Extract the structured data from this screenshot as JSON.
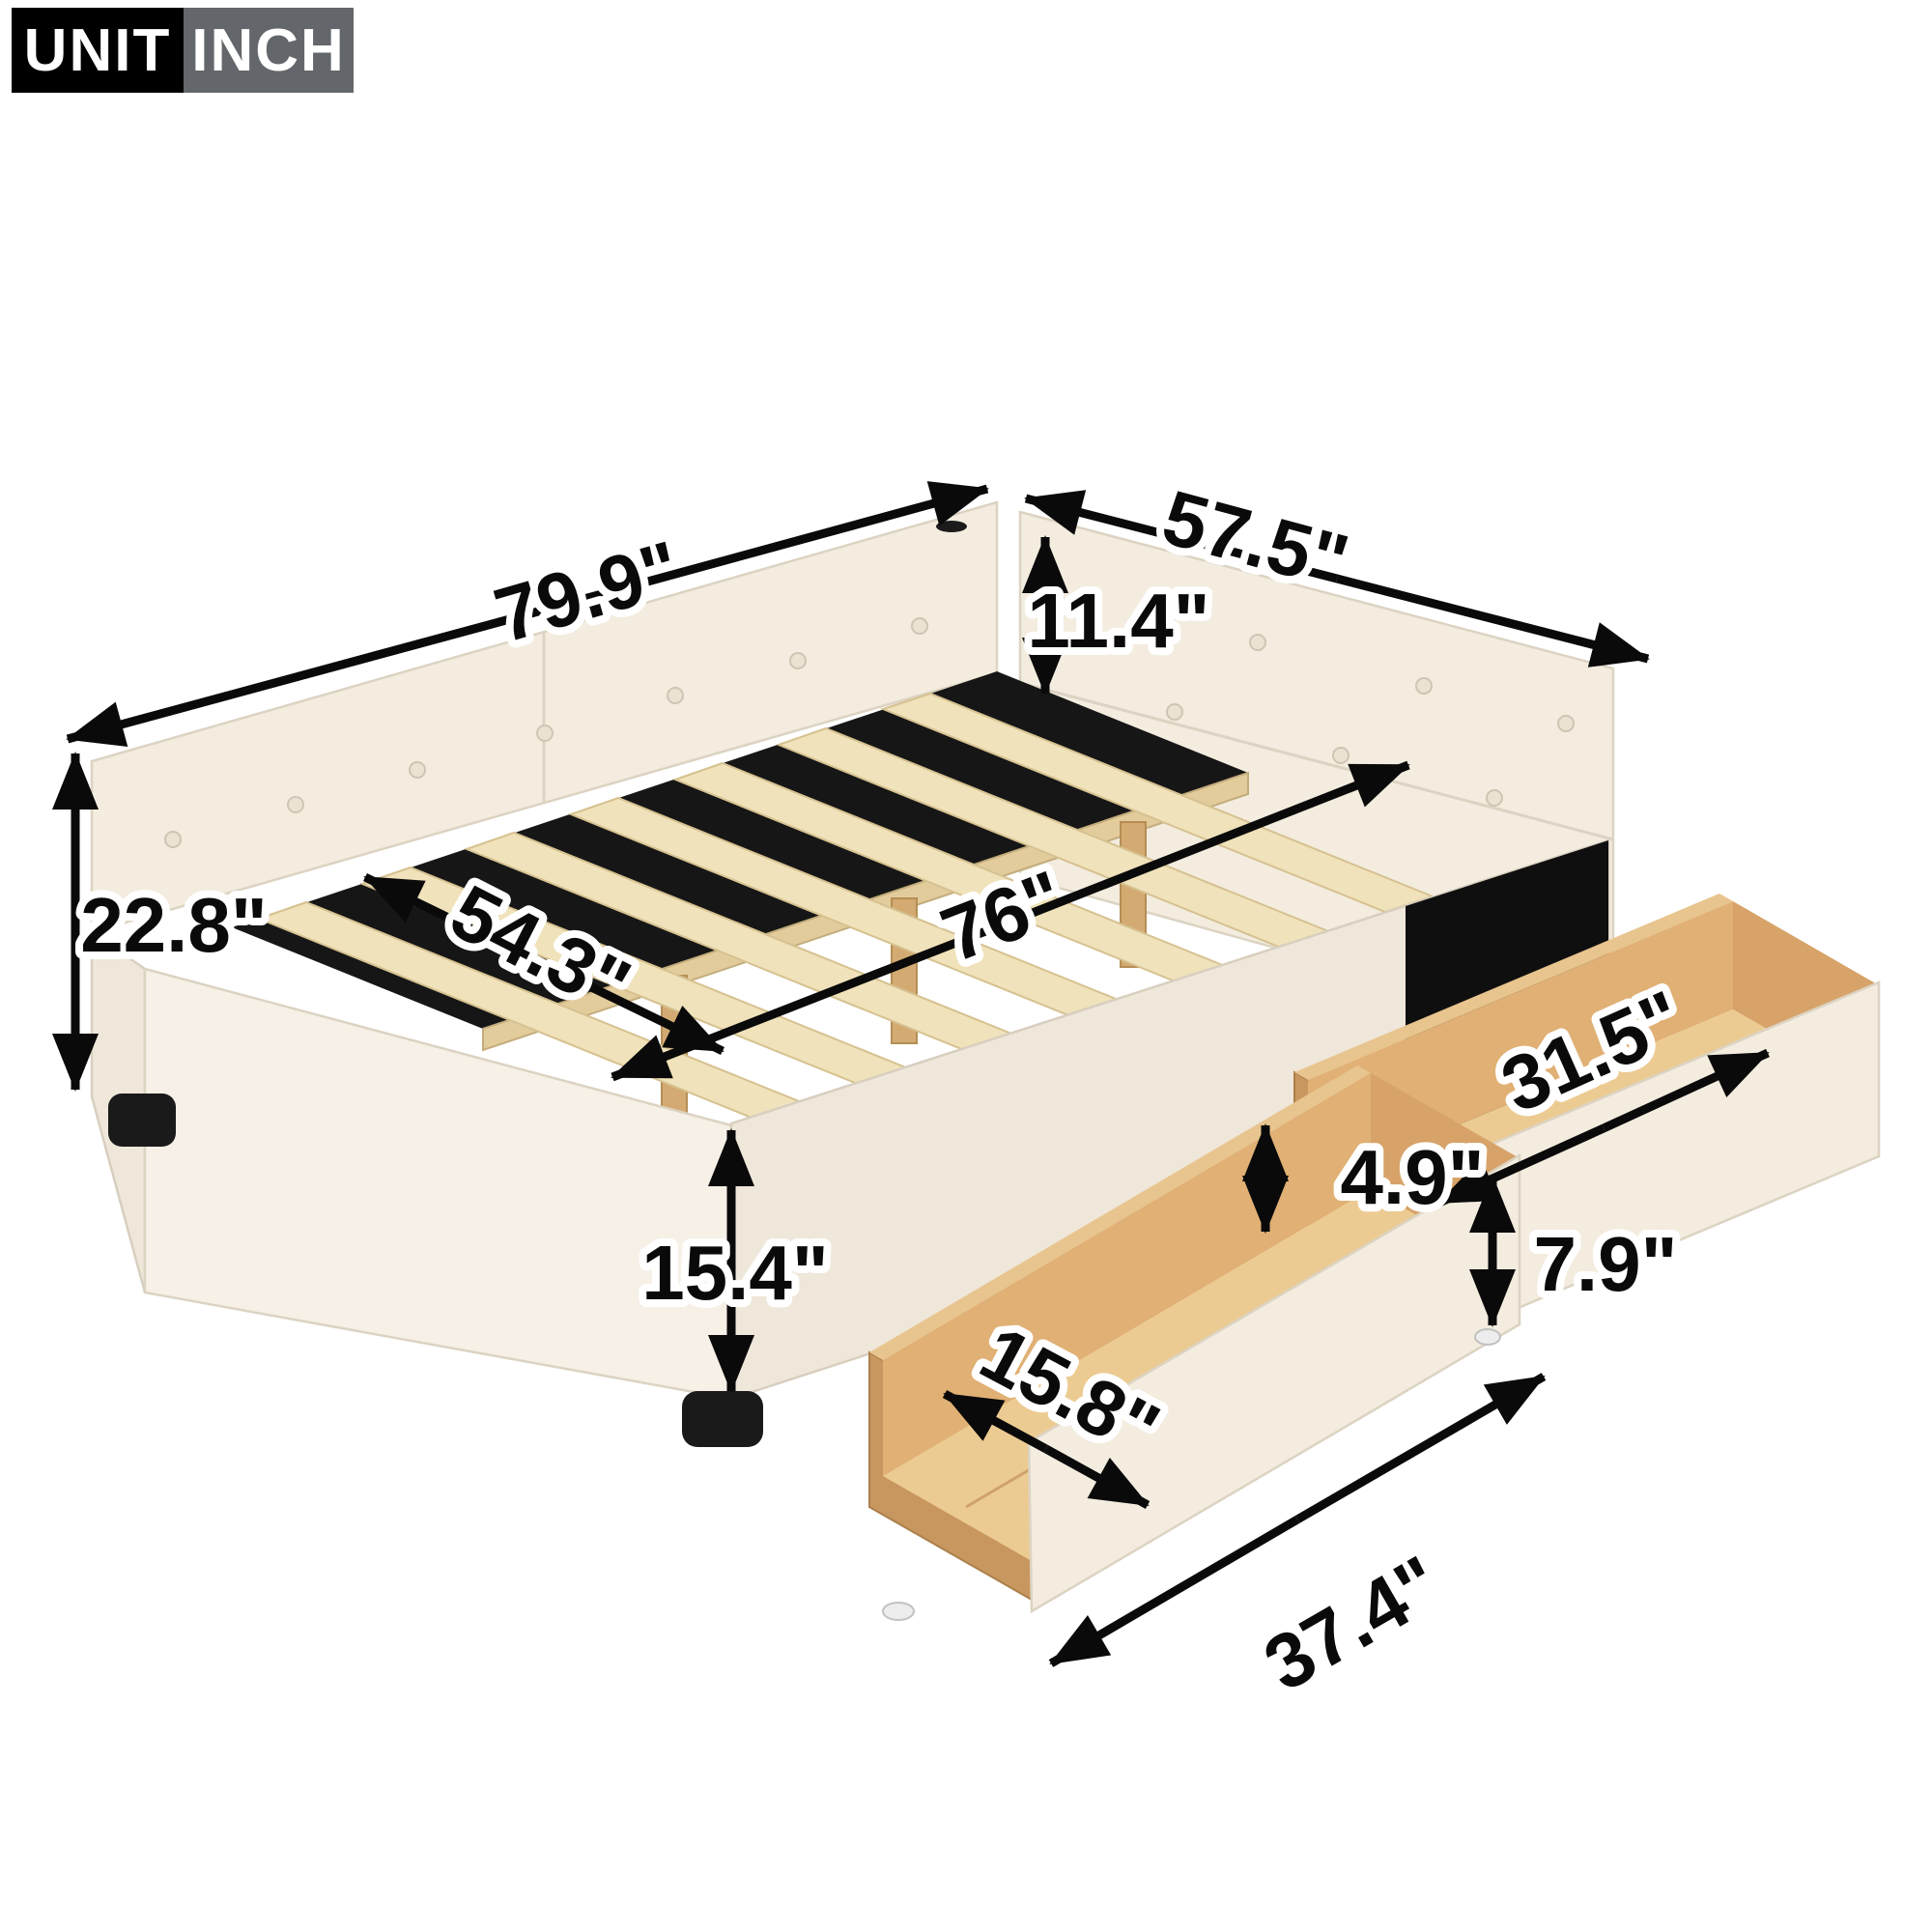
{
  "badge": {
    "label": "UNIT",
    "value": "INCH",
    "label_bg": "#000000",
    "value_bg": "#63666a",
    "text_color": "#ffffff"
  },
  "diagram": {
    "subject": "upholstered daybed with wooden slats and two storage drawers",
    "slat_count": 7,
    "drawer_count": 2,
    "colors": {
      "upholstery": "#f3ecdf",
      "slat_wood": "#f0e2ba",
      "drawer_wood": "#e8c48e",
      "deck_shadow": "#161616",
      "arrow": "#0a0a0a",
      "badge_gray": "#63666a"
    }
  },
  "dimensions": {
    "overall_length": {
      "label": "79.9\"",
      "value": 79.9,
      "unit": "inch",
      "measures": "overall length along back rail"
    },
    "overall_width": {
      "label": "57.5\"",
      "value": 57.5,
      "unit": "inch",
      "measures": "overall width along headboard side"
    },
    "back_height": {
      "label": "11.4\"",
      "value": 11.4,
      "unit": "inch",
      "measures": "back / side rail cushion height"
    },
    "total_height": {
      "label": "22.8\"",
      "value": 22.8,
      "unit": "inch",
      "measures": "total height at back"
    },
    "slat_span_width": {
      "label": "54.3\"",
      "value": 54.3,
      "unit": "inch",
      "measures": "inner slat width"
    },
    "slat_span_length": {
      "label": "76\"",
      "value": 76,
      "unit": "inch",
      "measures": "inner platform length"
    },
    "side_height": {
      "label": "15.4\"",
      "value": 15.4,
      "unit": "inch",
      "measures": "side rail height to floor"
    },
    "drawer_inner_length": {
      "label": "31.5\"",
      "value": 31.5,
      "unit": "inch",
      "measures": "rear drawer inner length"
    },
    "drawer_inner_height": {
      "label": "4.9\"",
      "value": 4.9,
      "unit": "inch",
      "measures": "drawer inner depth"
    },
    "drawer_front_height": {
      "label": "7.9\"",
      "value": 7.9,
      "unit": "inch",
      "measures": "drawer front panel height"
    },
    "drawer_inner_width": {
      "label": "15.8\"",
      "value": 15.8,
      "unit": "inch",
      "measures": "front drawer inner width"
    },
    "drawer_length": {
      "label": "37.4\"",
      "value": 37.4,
      "unit": "inch",
      "measures": "drawer overall length"
    }
  }
}
